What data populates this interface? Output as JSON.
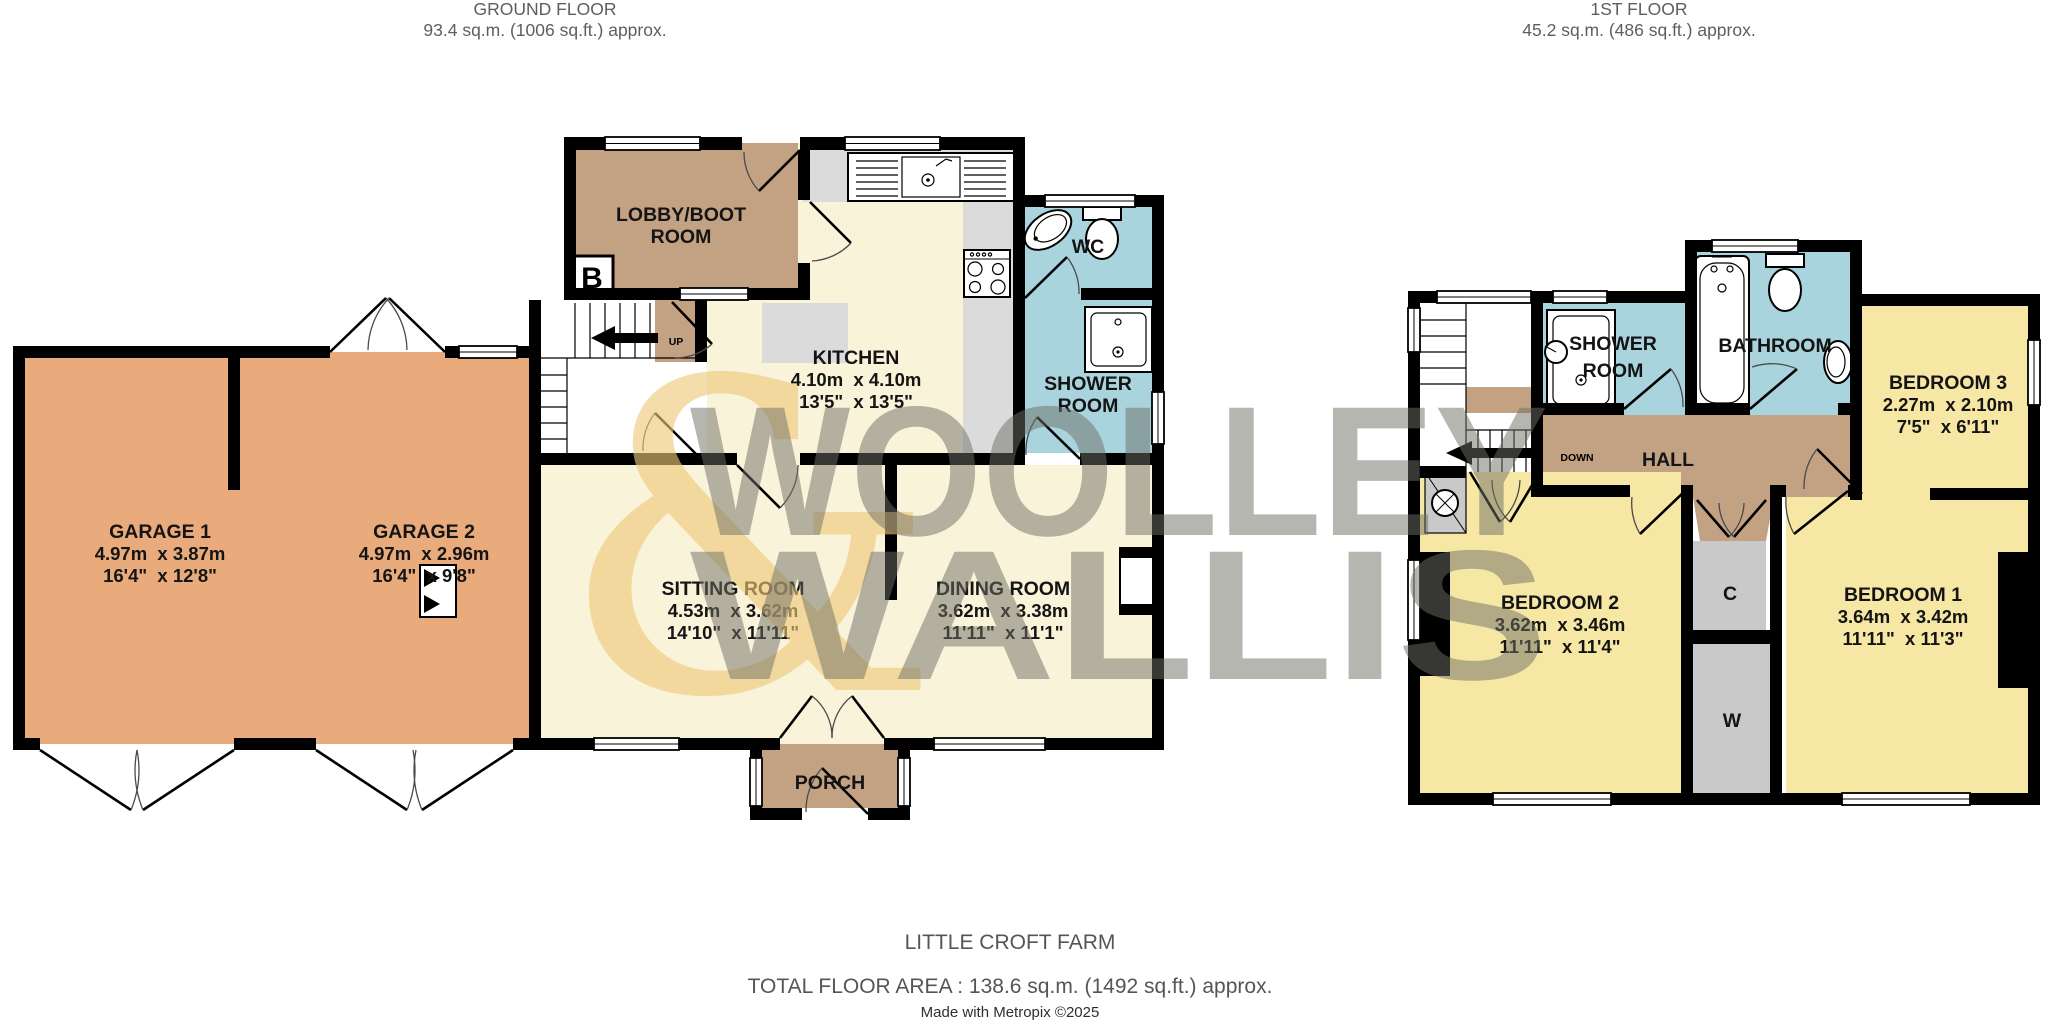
{
  "ground_floor": {
    "title": "GROUND FLOOR",
    "area_label": "93.4 sq.m. (1006 sq.ft.) approx.",
    "rooms": {
      "lobby": {
        "line1": "LOBBY/BOOT",
        "line2": "ROOM"
      },
      "kitchen": {
        "name": "KITCHEN",
        "metric": "4.10m  x 4.10m",
        "imperial": "13'5\"  x 13'5\""
      },
      "wc": {
        "name": "WC"
      },
      "shower_room": {
        "line1": "SHOWER",
        "line2": "ROOM"
      },
      "garage1": {
        "name": "GARAGE 1",
        "metric": "4.97m  x 3.87m",
        "imperial": "16'4\"  x 12'8\""
      },
      "garage2": {
        "name": "GARAGE 2",
        "metric": "4.97m  x 2.96m",
        "imperial": "16'4\"  x 9'8\""
      },
      "sitting": {
        "name": "SITTING ROOM",
        "metric": "4.53m  x 3.62m",
        "imperial": "14'10\"  x 11'11\""
      },
      "dining": {
        "name": "DINING ROOM",
        "metric": "3.62m  x 3.38m",
        "imperial": "11'11\"  x 11'1\""
      },
      "porch": {
        "name": "PORCH"
      }
    },
    "stairs_label": "UP",
    "boiler_label": "B"
  },
  "first_floor": {
    "title": "1ST FLOOR",
    "area_label": "45.2 sq.m. (486 sq.ft.) approx.",
    "rooms": {
      "shower_room": {
        "line1": "SHOWER",
        "line2": "ROOM"
      },
      "bathroom": {
        "name": "BATHROOM"
      },
      "hall": {
        "name": "HALL"
      },
      "bedroom1": {
        "name": "BEDROOM 1",
        "metric": "3.64m  x 3.42m",
        "imperial": "11'11\"  x 11'3\""
      },
      "bedroom2": {
        "name": "BEDROOM 2",
        "metric": "3.62m  x 3.46m",
        "imperial": "11'11\"  x 11'4\""
      },
      "bedroom3": {
        "name": "BEDROOM 3",
        "metric": "2.27m  x 2.10m",
        "imperial": "7'5\"  x 6'11\""
      },
      "cupboard": {
        "name": "C"
      },
      "wardrobe": {
        "name": "W"
      }
    },
    "stairs_label": "DOWN"
  },
  "watermark": {
    "word1": "WOOLLEY",
    "ampersand": "&",
    "word2": "WALLIS"
  },
  "footer": {
    "property_name": "LITTLE CROFT FARM",
    "total_area": "TOTAL FLOOR AREA : 138.6 sq.m. (1492 sq.ft.) approx.",
    "credit": "Made with Metropix ©2025"
  },
  "colors": {
    "wall": "#000000",
    "living_cream": "#f9f3da",
    "hall_brown": "#c3a284",
    "garage_orange": "#e9ab7c",
    "wet_blue": "#a9d4dd",
    "bedroom_yellow": "#f6e7a4",
    "cupboard_gray": "#c9c9c9",
    "counter_gray": "#dbdbdb",
    "watermark_gray": "#6f6f66",
    "watermark_amber": "#f0c979",
    "header_text": "#5e5e5e",
    "footer_text": "#555555"
  }
}
